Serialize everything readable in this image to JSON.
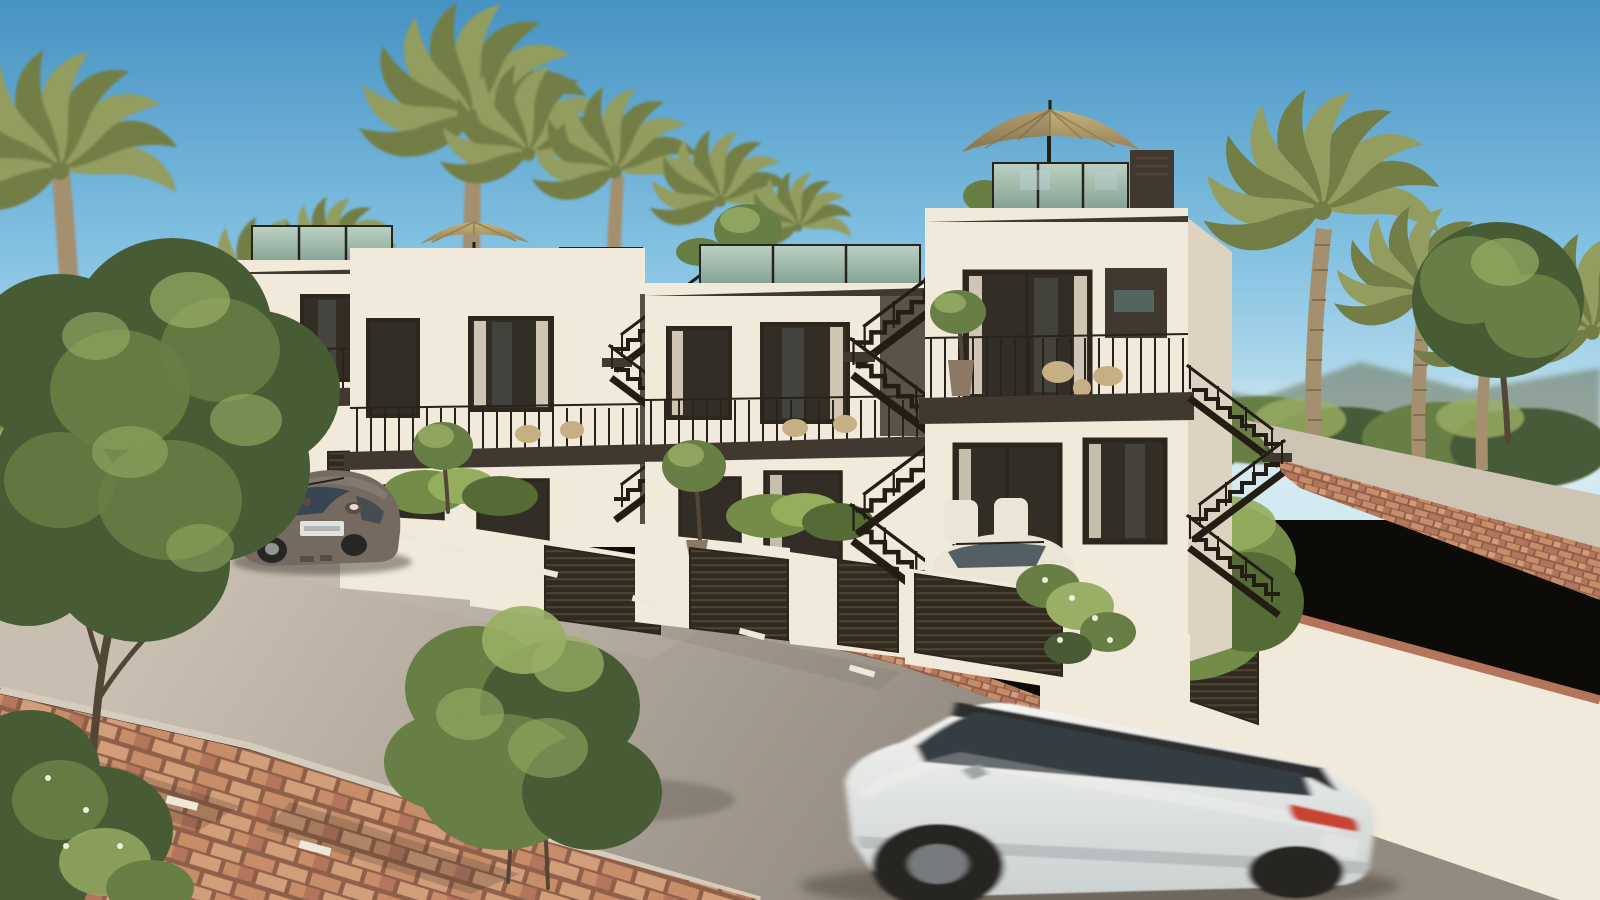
{
  "scene": {
    "type": "architectural-exterior-render",
    "setting": "Sunny photorealistic render of a row of modern white terraced townhouses on a sloping street lined with palm trees",
    "time_of_day": "daytime, warm sunlight from the right",
    "objects": [
      "blue gradient sky",
      "distant hazy hills",
      "tall palm trees left and right",
      "four stepped modern townhouses with rooftop terraces",
      "teal glass roof balustrades",
      "tan patio umbrellas on two roof terraces",
      "black external zigzag staircases",
      "balconies with black metal railings and wicker chairs",
      "dark louvered garage gates",
      "trimmed hedges and potted olive trees",
      "asphalt street with white dashed centerline",
      "terracotta brick paved sidewalks and kerbs",
      "grey-brown beetle car parked on the left",
      "small white car parked in a driveway",
      "white suv driving in the foreground with motion blur",
      "dark leafy foreground tree and bushes",
      "cream retaining wall with large hedge on the right",
      "uphill side road edged with brick"
    ]
  },
  "palette": {
    "sky-top": "#3d8fc6",
    "sky-mid": "#7fc2e6",
    "sky-horizon": "#cfeaf6",
    "hill": "#5f6c54",
    "palm-frond": "#8e9a5c",
    "palm-frond-dark": "#6c7a42",
    "palm-trunk": "#a08c6d",
    "palm-trunk-dark": "#7c6a4e",
    "wall": "#f1eadd",
    "wall-shade": "#ddd3c2",
    "wall-dim": "#e7ddcd",
    "fascia": "#37302a",
    "frame": "#221d17",
    "glass-dark": "#27251f",
    "glass-teal": "#49605c",
    "glass-reflect": "#bcd3de",
    "curtain": "#ece2cf",
    "balu-top": "#b9d1c5",
    "balu-bot": "#7c9f92",
    "rail": "#1d1a16",
    "stair": "#18140f",
    "umbrella-light": "#c3ad79",
    "umbrella-dark": "#8f7d52",
    "hedge-light": "#8fac5b",
    "hedge-mid": "#6c8a44",
    "hedge-dark": "#4c6630",
    "foliage-light": "#93ad62",
    "foliage-mid": "#5f7a40",
    "foliage-dark": "#3e5530",
    "pot": "#857463",
    "trunk-brown": "#4b3f31",
    "louver-bg": "#262119",
    "louver-line": "#453d31",
    "road-far": "#c6beb2",
    "road-near": "#8e8780",
    "road-upper": "#ccc3b6",
    "brick-a": "#c58a67",
    "brick-b": "#b0705a",
    "brick-c": "#d09a78",
    "brick-joint": "#8a5a45",
    "kerb-stone": "#d4ccc0",
    "line-white": "#eee9dd",
    "beetle-body": "#6e655d",
    "beetle-shade": "#4e463f",
    "beetle-glass": "#2e3e4e",
    "suv-body0": "#f4f6f6",
    "suv-body1": "#c9d1d4",
    "suv-shade": "#9aa4a8",
    "suv-glass": "#2c343c",
    "suv-roof": "#23272b",
    "tail-red": "#c63b2e",
    "plate-white": "#dfe3e4",
    "wheel-dark": "#1c1d1f",
    "shadow": "#2e2a24",
    "chair-white": "#eae6da",
    "wicker": "#c5ad83",
    "flower-white": "#f0f2e4"
  }
}
